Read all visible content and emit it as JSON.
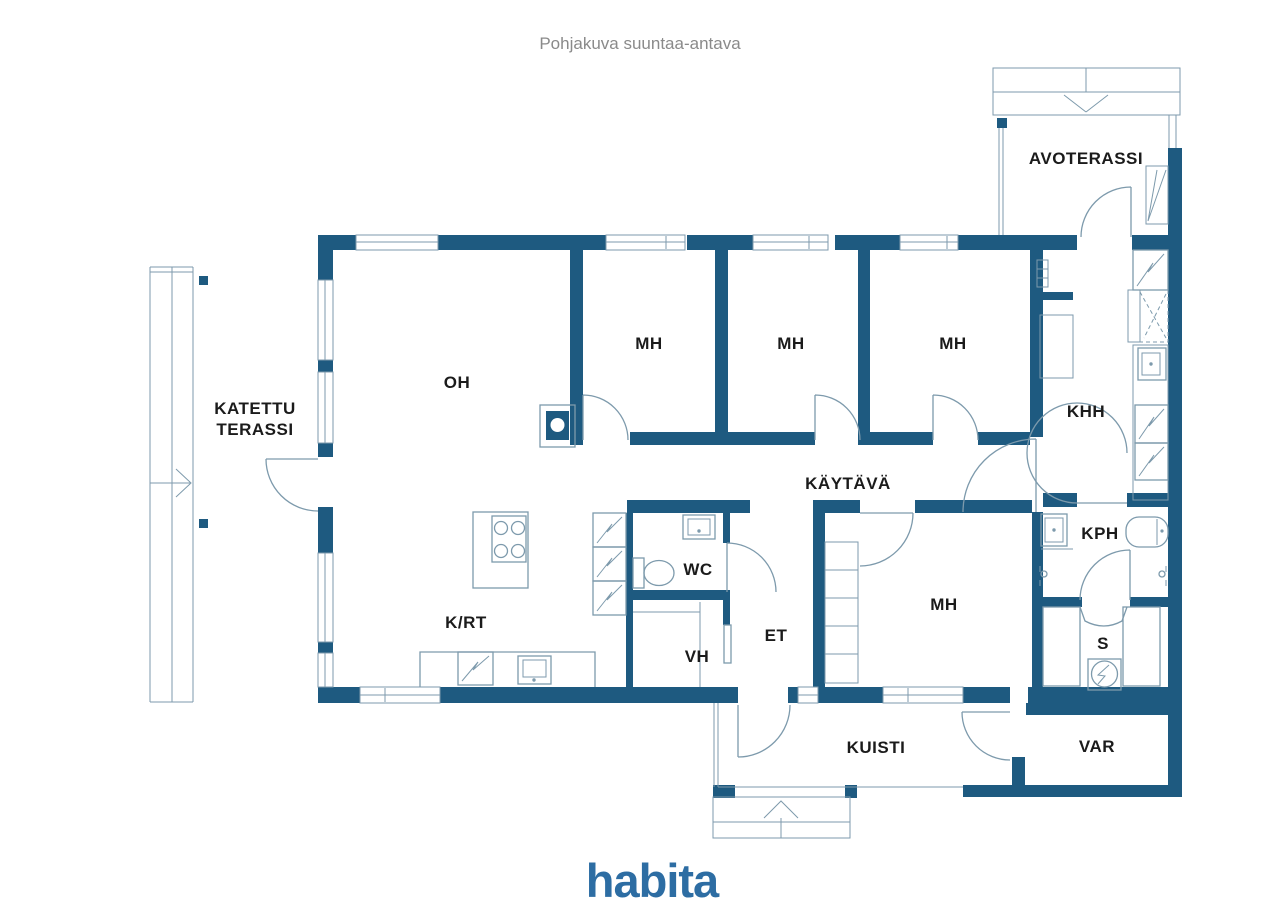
{
  "title": "Pohjakuva suuntaa-antava",
  "brand": {
    "logo_text": "habita",
    "logo_color": "#2d6da3"
  },
  "colors": {
    "wall": "#1e5a80",
    "line": "#7d9aac",
    "text": "#1b1b1b",
    "title_text": "#8a8a8a",
    "background": "#ffffff"
  },
  "rooms": {
    "avoterassi": "AVOTERASSI",
    "katettu_terassi_line1": "KATETTU",
    "katettu_terassi_line2": "TERASSI",
    "oh": "OH",
    "mh1": "MH",
    "mh2": "MH",
    "mh3": "MH",
    "mh4": "MH",
    "khh": "KHH",
    "kaytava": "KÄYTÄVÄ",
    "wc": "WC",
    "krt": "K/RT",
    "vh": "VH",
    "et": "ET",
    "kph": "KPH",
    "s": "S",
    "kuisti": "KUISTI",
    "var": "VAR"
  }
}
